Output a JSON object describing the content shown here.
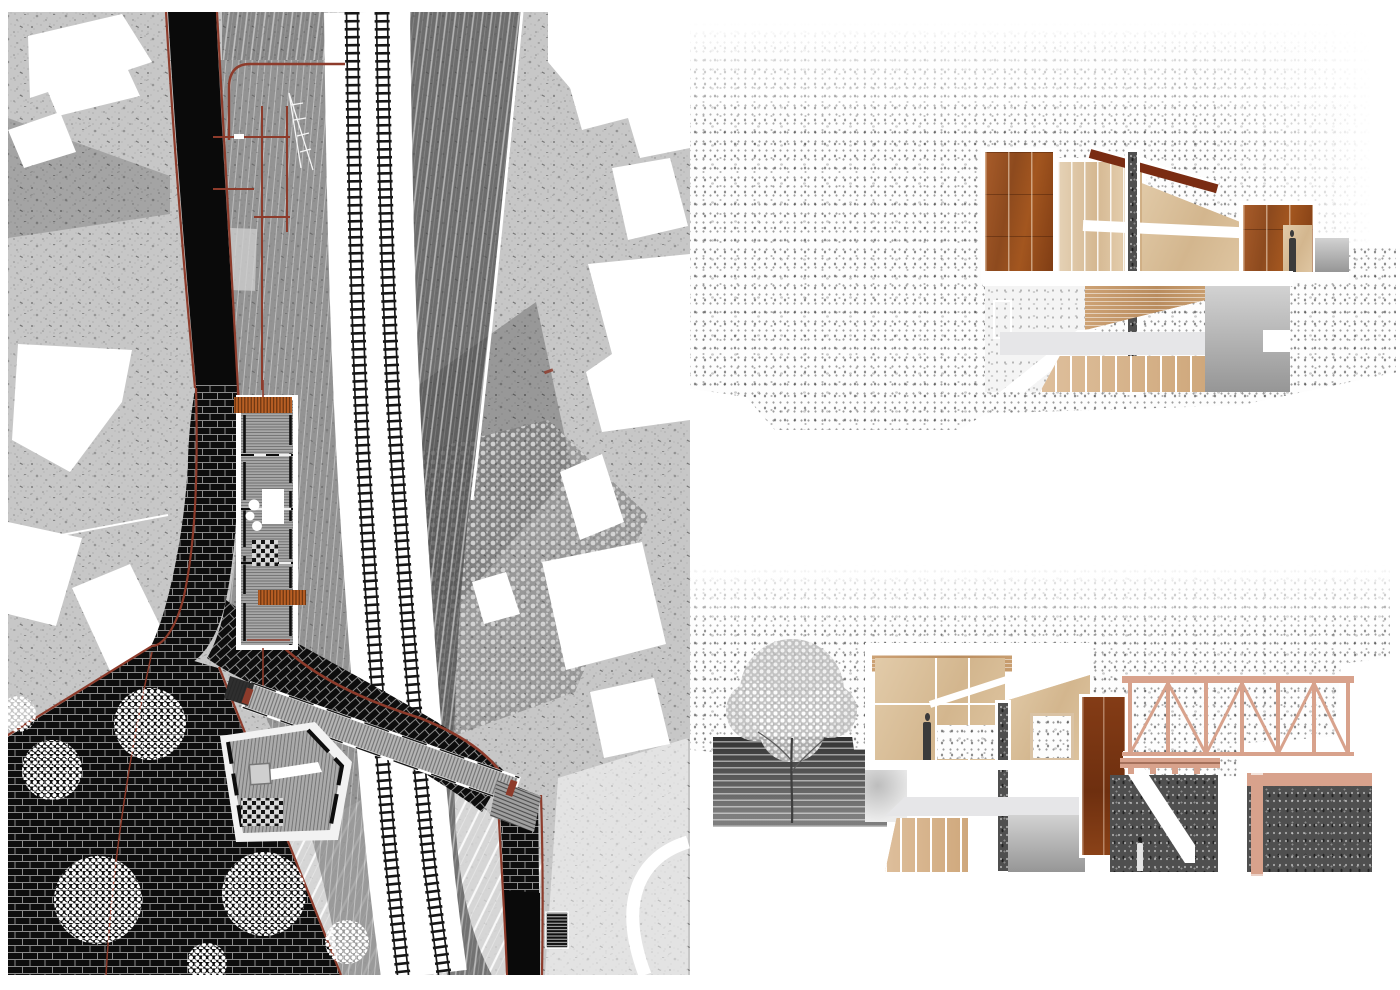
{
  "artboard": {
    "width": 1400,
    "height": 990,
    "background": "#ffffff",
    "description": "Architectural presentation board: left half is a textured site plan of a railway station landscape; right half shows two sectional collage drawings"
  },
  "palette": {
    "paper": "#ffffff",
    "map-base": "#c7c7c7",
    "ink": "#0d0d0d",
    "rust-line": "#8d3b2b",
    "stair-orange": "#b85f24",
    "corten": "#9c5222",
    "corten-deep": "#7a3414",
    "roof-beam": "#7a2c12",
    "plywood": "#dcc0a2",
    "plywood-light": "#e8d7bd",
    "wood-floor": "#c49a6c",
    "truss-pink": "#d8a28c",
    "mass-gray": "#4f4f4f",
    "floor-gray": "#e6e6e8",
    "lawn": "#cfcfcf"
  },
  "plan": {
    "name": "site-plan",
    "features": [
      "city-figure-ground",
      "black-brick-promenade",
      "railway-tracks",
      "station-building",
      "platform-canopy-grid",
      "foot-bridge",
      "timber-pavilion",
      "trees",
      "lawn-terraces",
      "crane-outline"
    ]
  },
  "sections": [
    {
      "name": "section-upper",
      "elements": [
        "corten-clad-volume",
        "plywood-volume",
        "sloped-roof-beam",
        "steel-column",
        "upper-floor-slab",
        "corten-entry-volume",
        "standing-person",
        "lower-level-stair",
        "wood-ceiling",
        "ground-texture"
      ]
    },
    {
      "name": "section-lower",
      "elements": [
        "tree",
        "terraced-earth-section",
        "plywood-interior",
        "standing-person",
        "steel-column",
        "corten-wall",
        "descending-stair",
        "timber-truss-bridge",
        "walking-person",
        "dark-ground-masses",
        "pink-deck-beams"
      ]
    }
  ]
}
